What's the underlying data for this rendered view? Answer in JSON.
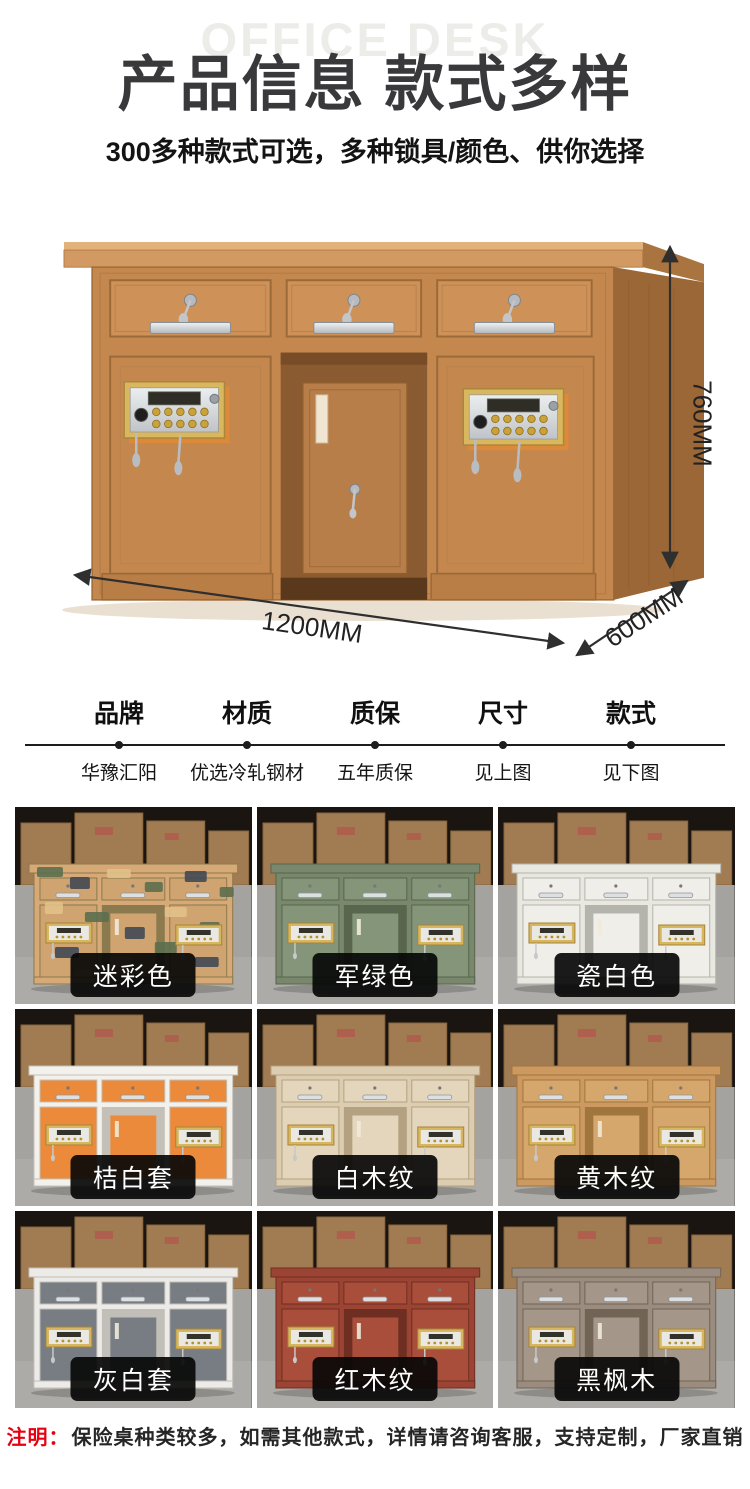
{
  "header": {
    "watermark": "OFFICE DESK",
    "title": "产品信息 款式多样",
    "subtitle": "300多种款式可选，多种锁具/颜色、供你选择"
  },
  "hero": {
    "height_label": "760MM",
    "width_label": "1200MM",
    "depth_label": "600MM"
  },
  "specs": [
    {
      "label": "品牌",
      "value": "华豫汇阳"
    },
    {
      "label": "材质",
      "value": "优选冷轧钢材"
    },
    {
      "label": "质保",
      "value": "五年质保"
    },
    {
      "label": "尺寸",
      "value": "见上图"
    },
    {
      "label": "款式",
      "value": "见下图"
    }
  ],
  "grid": {
    "items": [
      {
        "label": "迷彩色",
        "camo": true,
        "colors": {
          "frame": "#d7a977",
          "panel": "#cfa470",
          "dark": "#8a7a4e"
        }
      },
      {
        "label": "军绿色",
        "camo": false,
        "colors": {
          "frame": "#79886c",
          "panel": "#84957a",
          "dark": "#57664d"
        }
      },
      {
        "label": "瓷白色",
        "camo": false,
        "colors": {
          "frame": "#e8e7e0",
          "panel": "#efeee8",
          "dark": "#b5b4ac"
        }
      },
      {
        "label": "桔白套",
        "camo": false,
        "colors": {
          "frame": "#f3f1ec",
          "panel": "#ea8a3a",
          "dark": "#c4c0b8"
        }
      },
      {
        "label": "白木纹",
        "camo": false,
        "colors": {
          "frame": "#dccdb1",
          "panel": "#e4d6bc",
          "dark": "#b3a181"
        }
      },
      {
        "label": "黄木纹",
        "camo": false,
        "colors": {
          "frame": "#cc9a60",
          "panel": "#d6a76c",
          "dark": "#a1763e"
        }
      },
      {
        "label": "灰白套",
        "camo": false,
        "colors": {
          "frame": "#edebe7",
          "panel": "#787d84",
          "dark": "#c2bfb9"
        }
      },
      {
        "label": "红木纹",
        "camo": false,
        "colors": {
          "frame": "#9c4434",
          "panel": "#a84e3a",
          "dark": "#6f2e22"
        }
      },
      {
        "label": "黑枫木",
        "camo": false,
        "colors": {
          "frame": "#9a8c7f",
          "panel": "#a49689",
          "dark": "#716454"
        }
      }
    ]
  },
  "footnote": {
    "prefix": "注明：",
    "text": "保险桌种类较多，如需其他款式，详情请咨询客服，支持定制，厂家直销"
  },
  "palette": {
    "accent_red": "#e60012",
    "arrow": "#2f2f2f",
    "hero_wood": "#c4884f",
    "lock_gold": "#d9b75f",
    "badge_bg": "#0a0a0a"
  }
}
